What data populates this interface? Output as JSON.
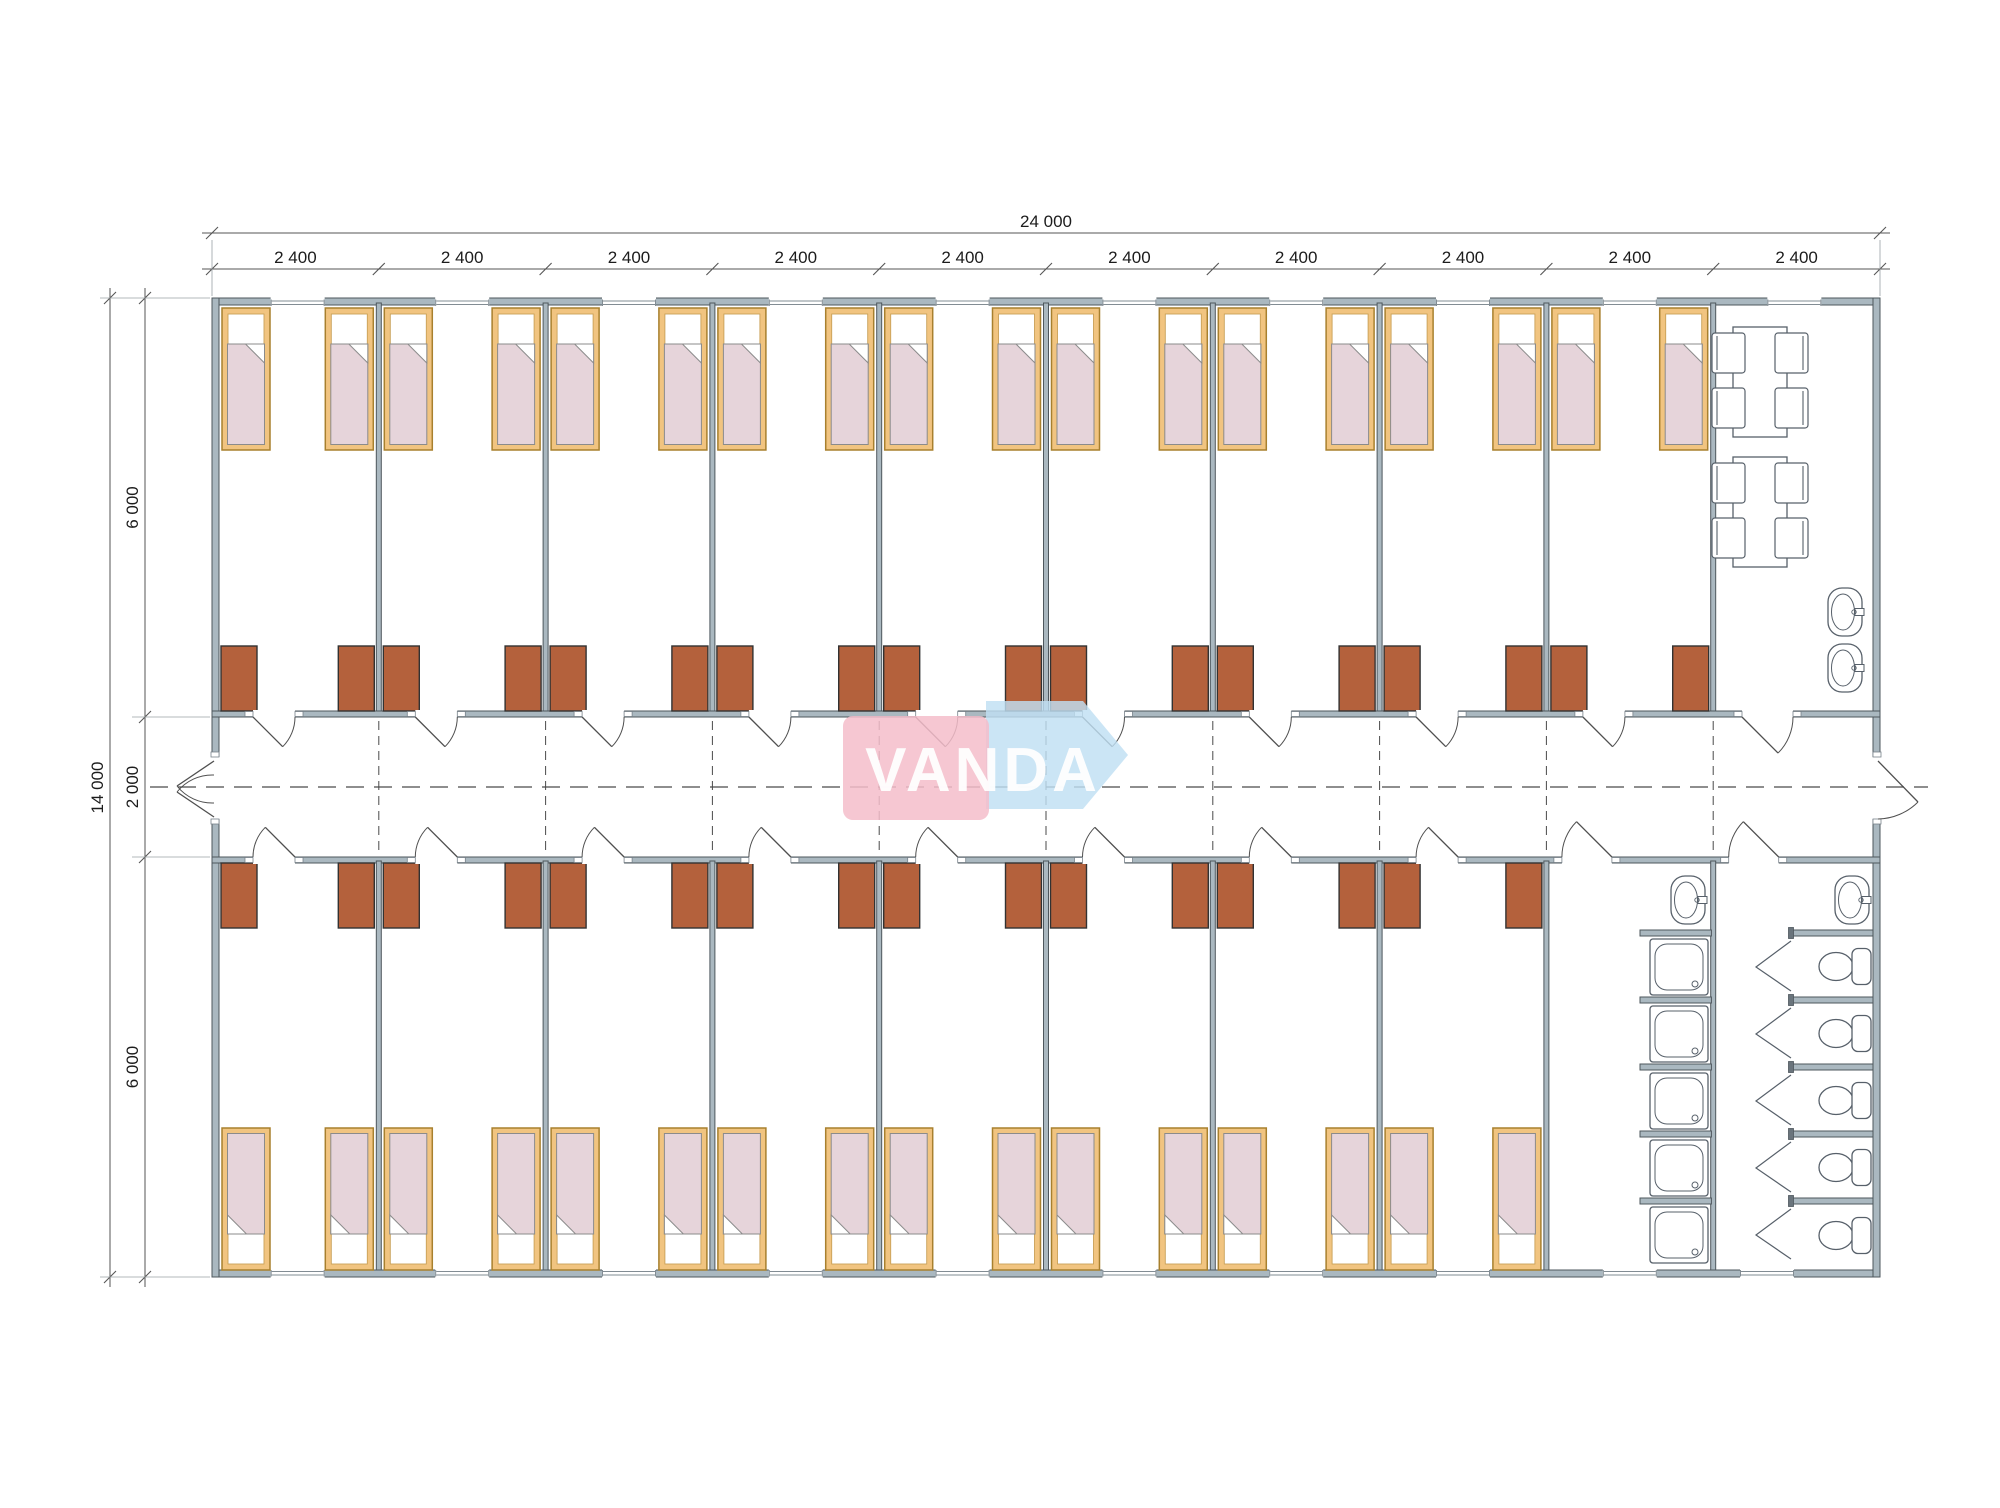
{
  "drawing": {
    "type": "dormitory-floor-plan",
    "watermark_text": "VANDA"
  },
  "dimensions": {
    "overall_width_label": "24 000",
    "bay_width_labels": [
      "2 400",
      "2 400",
      "2 400",
      "2 400",
      "2 400",
      "2 400",
      "2 400",
      "2 400",
      "2 400",
      "2 400"
    ],
    "overall_height_label": "14 000",
    "height_segment_labels": [
      "6 000",
      "2 000",
      "6 000"
    ]
  },
  "rooms": {
    "top_bedrooms": 9,
    "bottom_bedrooms": 8,
    "beds_per_bedroom": 2,
    "wardrobes_per_bedroom": 2,
    "common_room": {
      "tables": 2,
      "chairs_per_table": 4,
      "sinks": 2
    },
    "washroom": {
      "sinks": 1,
      "showers": 5
    },
    "wc_room": {
      "sinks": 1,
      "toilets": 5,
      "stalls": 5
    }
  },
  "colors": {
    "wall_fill": "#aab8c0",
    "wall_stroke": "#4e575d",
    "jamb_fill": "#6a747c",
    "window_line": "#828c93",
    "bed_frame_fill": "#f1c480",
    "bed_frame_stroke": "#a8802e",
    "bed_inner_stroke": "#c9a057",
    "blanket_fill": "#e6d4da",
    "blanket_stroke": "#8b8b8b",
    "wardrobe_fill": "#b4613c",
    "wardrobe_stroke": "#323232",
    "fixture_stroke": "#57606a",
    "door_stroke": "#4f4f4f",
    "dash_stroke": "#4a4a4a",
    "dim_stroke": "#555555",
    "dim_text": "#1c1c1c",
    "ext_line": "#9aa0a5",
    "logo_pink": "#f5bdca",
    "logo_blue": "#bfdff3",
    "logo_text": "#ffffff"
  }
}
